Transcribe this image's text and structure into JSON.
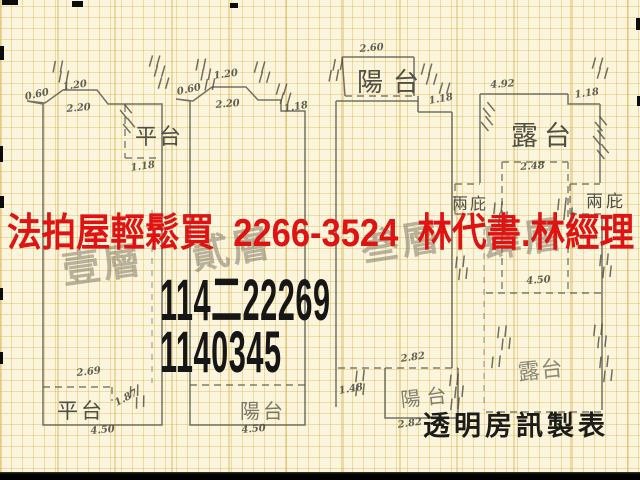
{
  "colors": {
    "paper": "#faf5dc",
    "grid": "#dcb44b",
    "ink": "#56554a",
    "overlay_red": "#e01212",
    "overlay_black": "#161616",
    "stamp_gray": "#766f5e"
  },
  "overlay": {
    "ad_line": "法拍屋輕鬆買  2266-3524  林代書.林經理",
    "case_no_top": "114二22269",
    "case_no_bottom": "1140345",
    "maker_credit": "透明房訊製表"
  },
  "floor_stamps": [
    "壹層",
    "貳層",
    "叁層",
    "肆層"
  ],
  "plans": [
    {
      "name": "floor-1",
      "area_labels": {
        "top_platform": "平台",
        "bottom_platform": "平台"
      },
      "dims": {
        "ledge": "0.60",
        "top": "1.20",
        "span": "2.20",
        "notch": "1.18",
        "inner": "2.69",
        "diag": "1.87",
        "width": "4.50"
      }
    },
    {
      "name": "floor-2",
      "area_labels": {
        "bottom_balcony": "陽台"
      },
      "dims": {
        "ledge": "0.60",
        "top": "1.20",
        "span": "2.20",
        "step": "1.18",
        "width": "4.50"
      }
    },
    {
      "name": "floor-3",
      "area_labels": {
        "top_balcony": "陽台",
        "bottom_balcony": "陽台"
      },
      "dims": {
        "balcony_width": "2.60",
        "step": "1.18",
        "inner": "2.82",
        "side": "1.48",
        "width": "2.82"
      }
    },
    {
      "name": "floor-4",
      "area_labels": {
        "top_terrace": "露台",
        "canopy_left": "兩庇",
        "canopy_right": "兩庇",
        "bottom_terrace": "露台"
      },
      "dims": {
        "top_width": "4.92",
        "step": "1.18",
        "inner": "2.48",
        "mid_width": "4.50"
      }
    }
  ]
}
